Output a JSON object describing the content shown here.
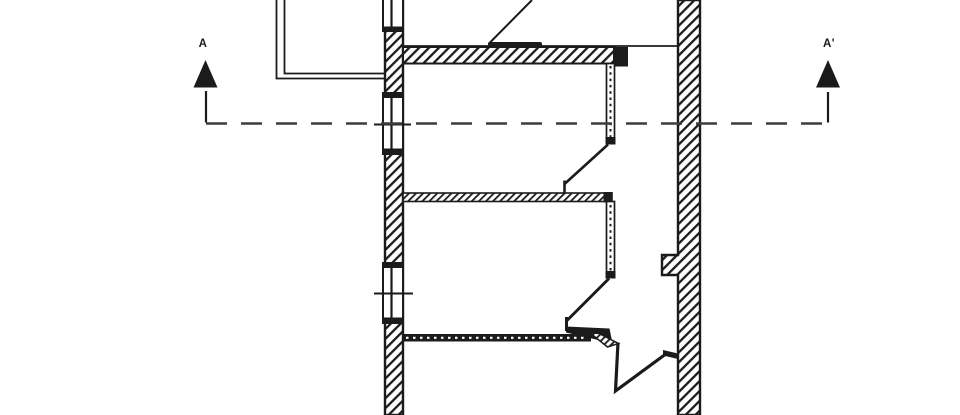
{
  "drawing": {
    "colors": {
      "ink": "#1b1b1b",
      "section_line": "#3d3d3d",
      "background": "#ffffff"
    },
    "section_markers": {
      "left": {
        "label": "A",
        "icon": "filled-triangle-up"
      },
      "right": {
        "label": "A'",
        "icon": "filled-triangle-up"
      }
    }
  }
}
